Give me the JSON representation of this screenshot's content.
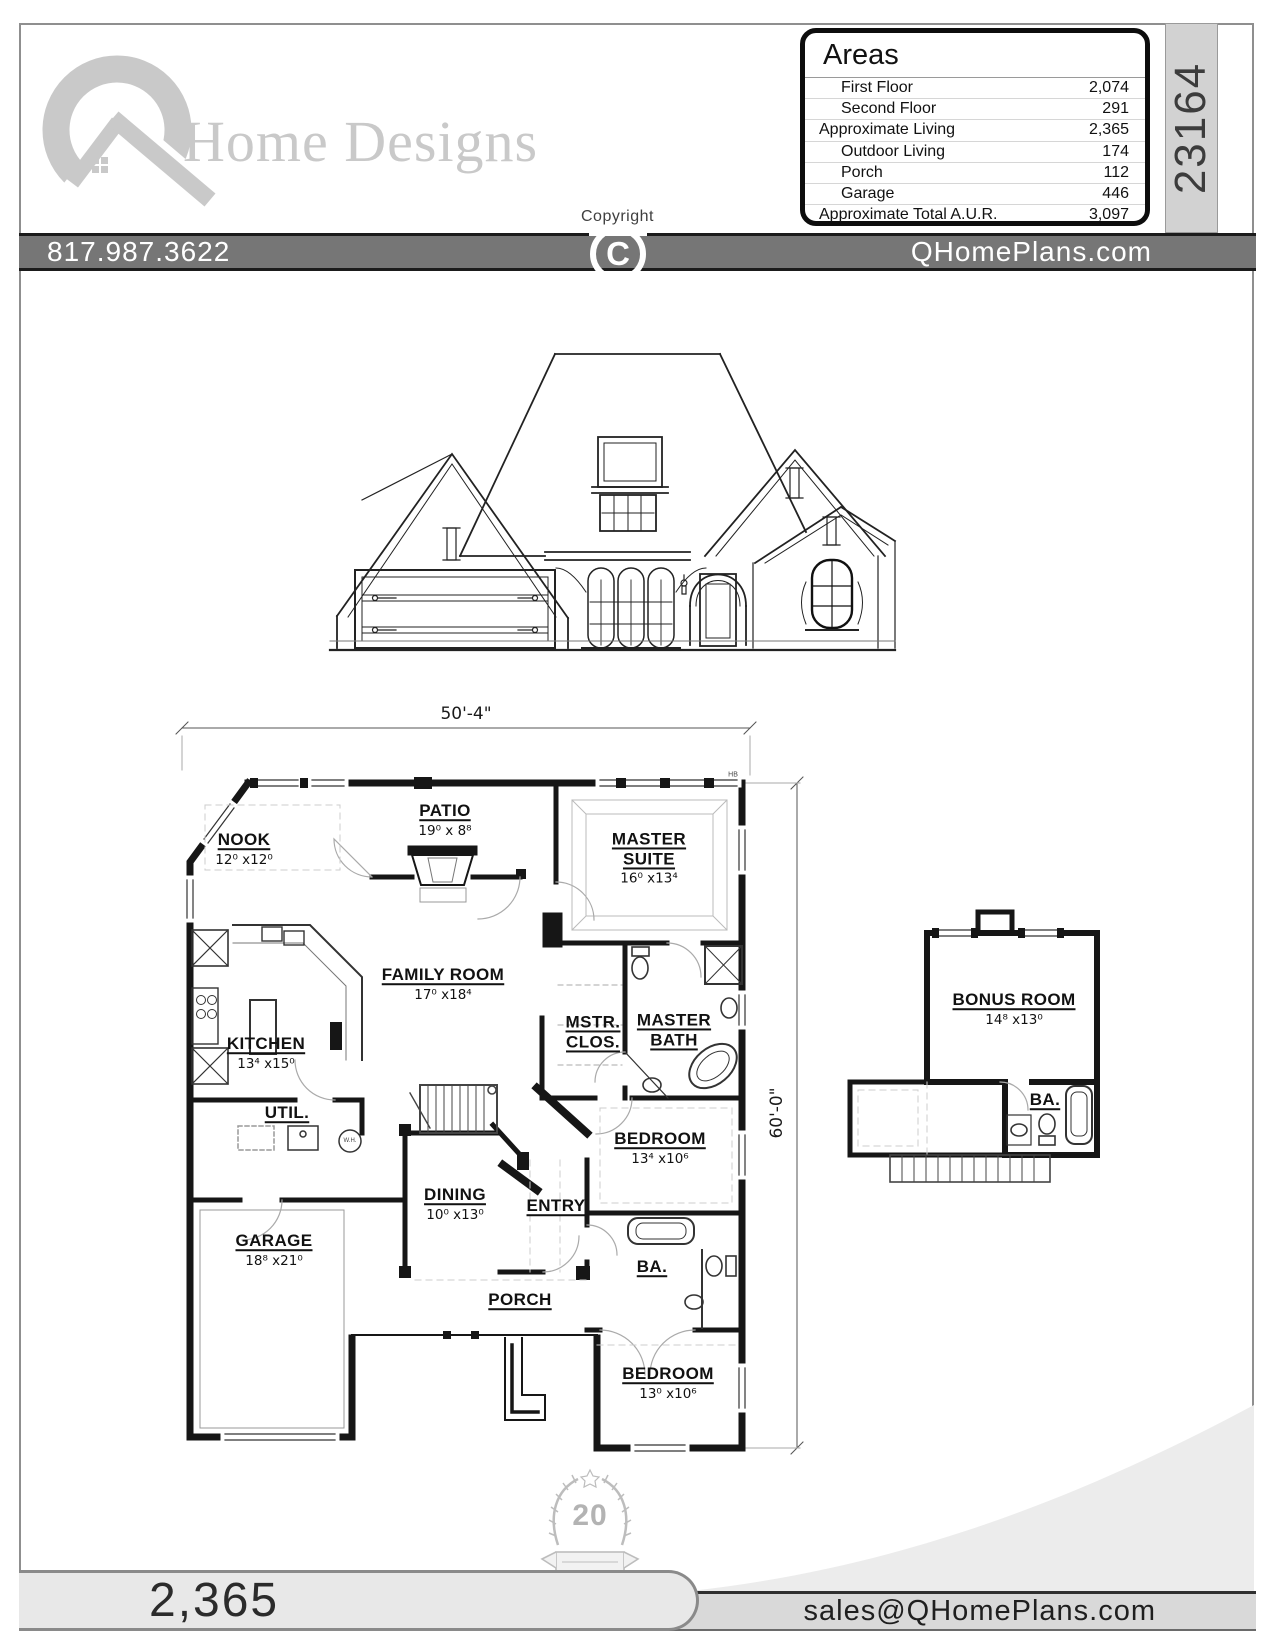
{
  "header": {
    "logo_text": "Home Designs",
    "copyright_label": "Copyright",
    "copyright_symbol": "C",
    "plan_number": "23164",
    "areas": {
      "title": "Areas",
      "rows": [
        {
          "label": "First Floor",
          "value": "2,074",
          "indent": true
        },
        {
          "label": "Second Floor",
          "value": "291",
          "indent": true
        },
        {
          "label": "Approximate Living",
          "value": "2,365",
          "indent": false
        },
        {
          "label": "Outdoor Living",
          "value": "174",
          "indent": true
        },
        {
          "label": "Porch",
          "value": "112",
          "indent": true
        },
        {
          "label": "Garage",
          "value": "446",
          "indent": true
        },
        {
          "label": "Approximate Total A.U.R.",
          "value": "3,097",
          "indent": false
        }
      ]
    }
  },
  "contact_bar": {
    "phone": "817.987.3622",
    "website": "QHomePlans.com"
  },
  "first_floor_plan": {
    "width_dim": "50'-4\"",
    "depth_dim": "60'-0\"",
    "hb_marker": "HB",
    "water_heater_label": "W.H.",
    "rooms": [
      {
        "id": "nook",
        "name": "NOOK",
        "dims": "12⁰ x12⁰"
      },
      {
        "id": "patio",
        "name": "PATIO",
        "dims": "19⁰ x 8⁸"
      },
      {
        "id": "master-suite",
        "name": "MASTER SUITE",
        "dims": "16⁰ x13⁴"
      },
      {
        "id": "family-room",
        "name": "FAMILY ROOM",
        "dims": "17⁰ x18⁴"
      },
      {
        "id": "kitchen",
        "name": "KITCHEN",
        "dims": "13⁴ x15⁰"
      },
      {
        "id": "mstr-clos",
        "name": "MSTR. CLOS.",
        "dims": ""
      },
      {
        "id": "master-bath",
        "name": "MASTER BATH",
        "dims": ""
      },
      {
        "id": "util",
        "name": "UTIL.",
        "dims": ""
      },
      {
        "id": "bedroom-1",
        "name": "BEDROOM",
        "dims": "13⁴ x10⁶"
      },
      {
        "id": "dining",
        "name": "DINING",
        "dims": "10⁰ x13⁰"
      },
      {
        "id": "entry",
        "name": "ENTRY",
        "dims": ""
      },
      {
        "id": "garage",
        "name": "GARAGE",
        "dims": "18⁸ x21⁰"
      },
      {
        "id": "porch",
        "name": "PORCH",
        "dims": ""
      },
      {
        "id": "bath-1",
        "name": "BA.",
        "dims": ""
      },
      {
        "id": "bedroom-2",
        "name": "BEDROOM",
        "dims": "13⁰ x10⁶"
      }
    ]
  },
  "second_floor_plan": {
    "rooms": [
      {
        "id": "bonus-room",
        "name": "BONUS ROOM",
        "dims": "14⁸ x13⁰"
      },
      {
        "id": "bath-2",
        "name": "BA.",
        "dims": ""
      }
    ]
  },
  "footer": {
    "living_area": "2,365",
    "email": "sales@QHomePlans.com",
    "badge_number": "20"
  }
}
